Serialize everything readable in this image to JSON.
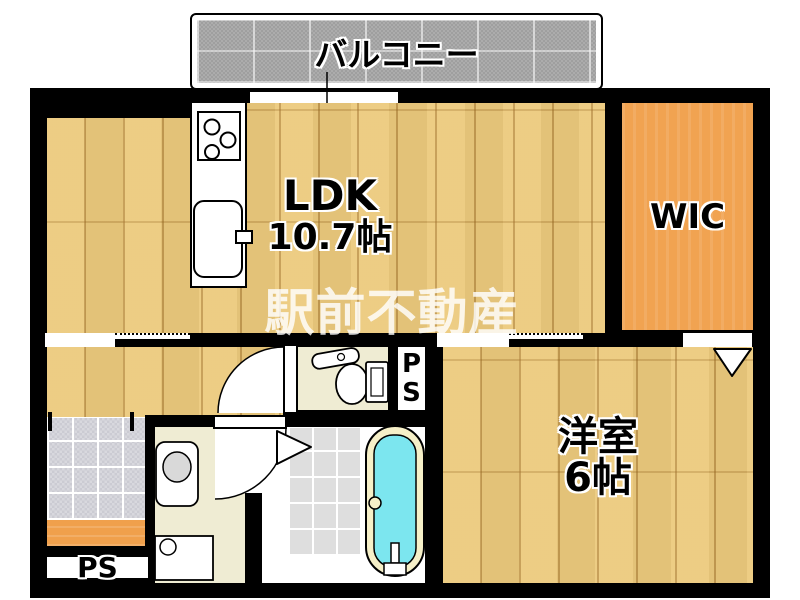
{
  "watermark": "駅前不動産",
  "rooms": {
    "balcony": {
      "label": "バルコニー"
    },
    "ldk": {
      "label": "LDK",
      "size": "10.7帖"
    },
    "wic": {
      "label": "WIC"
    },
    "western_room": {
      "label": "洋室",
      "size": "6帖"
    },
    "pipe_space_upper": {
      "letters": [
        "P",
        "S"
      ]
    },
    "pipe_space_lower": {
      "label": "PS"
    }
  },
  "fixtures": [
    "gas-stove",
    "kitchen-sink",
    "toilet",
    "washbasin",
    "washing-machine-pan",
    "bathtub",
    "door-swing",
    "folding-door",
    "closet-door-triangle",
    "sliding-window"
  ],
  "colors": {
    "wall": "#000000",
    "wood": "#ecca7d",
    "wood-line": "#b98f45",
    "wic-orange": "#f1a351",
    "balcony-gray": "#acacac",
    "entrance-tile": "#d8d8de",
    "cream": "#efecd3",
    "bath-tile": "#dedede",
    "tub-water": "#7ce6ef",
    "tub-rim": "#f6f0c8",
    "step-orange": "#f0a04c",
    "fixture-gray": "#d9d9d9"
  }
}
